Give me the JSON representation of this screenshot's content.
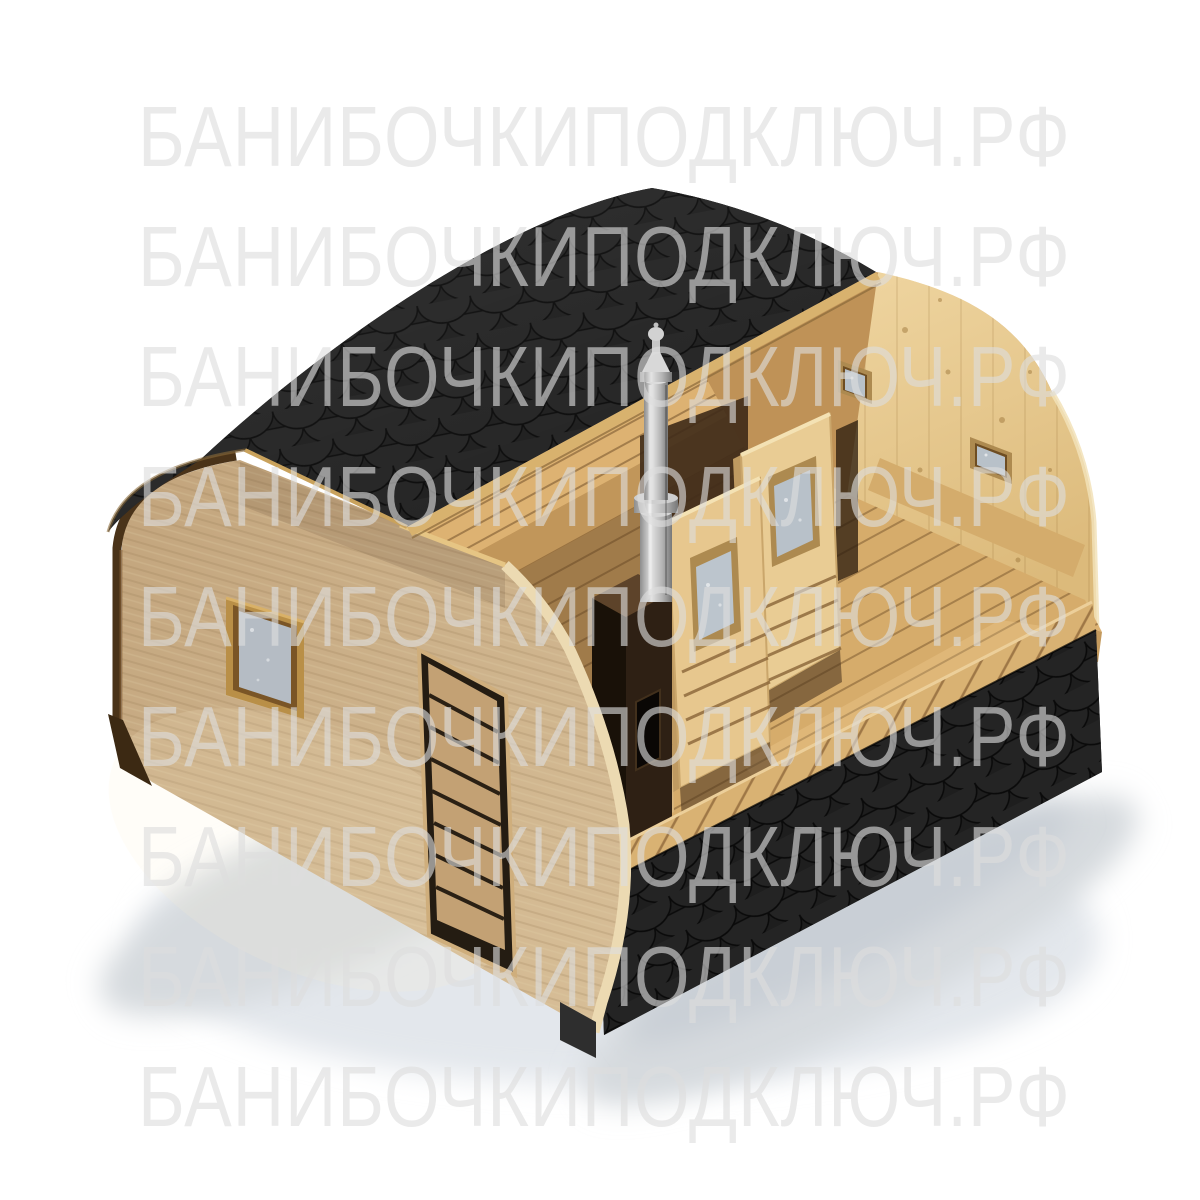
{
  "watermark": {
    "text": "БАНИБОЧКИПОДКЛЮЧ.РФ",
    "rows": 9,
    "color": "#dedede",
    "opacity": 0.62
  },
  "colors": {
    "background": "#ffffff",
    "roof": "#1d1d1d",
    "shingle_outline": "#0a0a0a",
    "roof_deck_edge": "#d8b26e",
    "front_wall": "#c9ae87",
    "wall_cut_face": "#ecdab2",
    "wall_rim": "#4a3319",
    "interior": "#bf9257",
    "back_wall": "#e9cb92",
    "floor": "#d6ac6b",
    "bench": "#ddb272",
    "rail": "#d9b273",
    "partition_door": "#e9cc94",
    "glass": "#b8c1c9",
    "glass_frame": "#ad8a50",
    "window_frame": "#b98f47",
    "entrance_door": "#c3a174",
    "stove": "#2e2014",
    "stove_top": "#5d432a",
    "chimney": "#c9c9c9",
    "base_skid": "#2e2e2e",
    "ground_shadow": "#d6dade"
  }
}
